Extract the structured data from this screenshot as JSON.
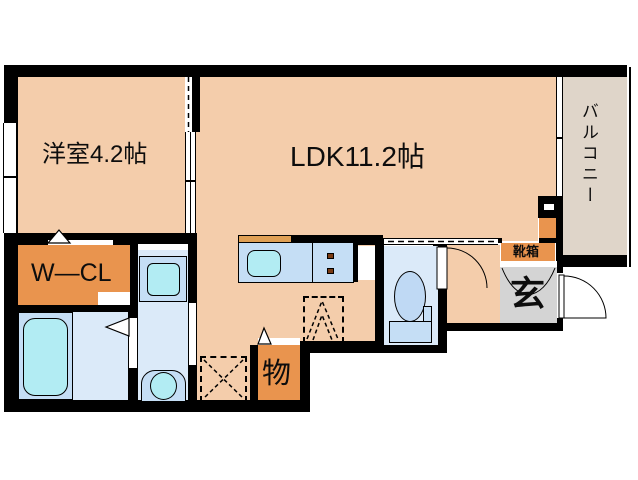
{
  "rooms": {
    "western_room": {
      "label": "洋室4.2帖"
    },
    "ldk": {
      "label": "LDK11.2帖"
    },
    "balcony": {
      "label": "バルコニー"
    },
    "walk_in_closet": {
      "label": "W—CL"
    },
    "storage": {
      "label": "物"
    },
    "entrance": {
      "label": "玄"
    },
    "shoe_box": {
      "label": "靴箱"
    }
  },
  "fixtures": [
    "bathtub",
    "washing-machine-pan",
    "vanity-basin",
    "toilet",
    "kitchen-sink",
    "ih-cooktop",
    "refrigerator-space",
    "equipment-space",
    "shoe-cabinet",
    "water-heater",
    "door-swing",
    "sliding-window"
  ],
  "colors": {
    "wall": "#000000",
    "room_fill": "#F4CDAB",
    "balcony_fill": "#DFD5C9",
    "accent_orange": "#E9944E",
    "counter_orange": "#DFA055",
    "entrance_gray": "#D4D4D4",
    "fixture_deck_blue": "#C5DEF5",
    "fixture_cyan": "#B2ECF3",
    "wet_floor_blue": "#DBEAF9",
    "toilet_bowl_blue": "#BFD9F4",
    "burner_brown": "#7A3A12"
  }
}
